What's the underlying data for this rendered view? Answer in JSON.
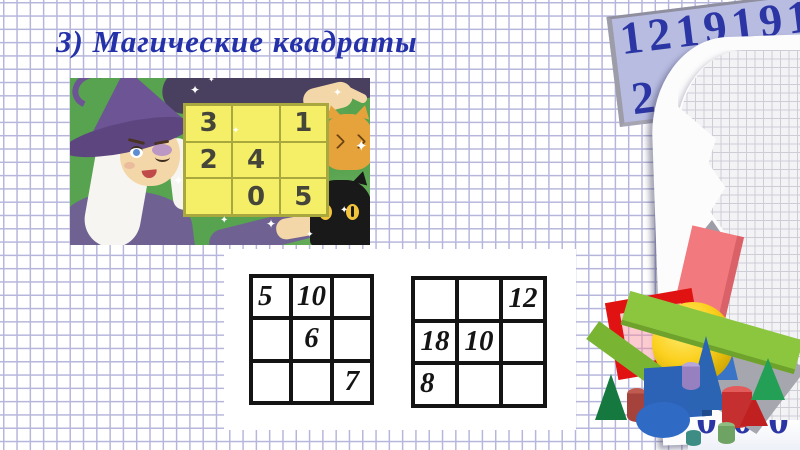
{
  "slide": {
    "title": "3) Магические квадраты"
  },
  "illustration": {
    "magic_square": {
      "rows": [
        [
          "3",
          "",
          "1"
        ],
        [
          "2",
          "4",
          ""
        ],
        [
          "",
          "0",
          "5"
        ]
      ]
    }
  },
  "puzzles": {
    "left": {
      "rows": [
        [
          "5",
          "10",
          ""
        ],
        [
          "",
          "6",
          ""
        ],
        [
          "",
          "",
          "7"
        ]
      ]
    },
    "right": {
      "rows": [
        [
          "",
          "",
          "12"
        ],
        [
          "18",
          "10",
          ""
        ],
        [
          "8",
          "",
          ""
        ]
      ]
    }
  },
  "decor": {
    "banner_row1": "1219191",
    "banner_row2": "222",
    "bottom_digits": "000",
    "sparkle_glyph": "✦"
  },
  "colors": {
    "title_blue": "#2531a8",
    "digit_blue": "#2b35a4",
    "grid_line": "#b6b6dc",
    "banner_bg": "#b8bce1",
    "witch_bg": "#58a350",
    "square_yellow": "#f5ef68",
    "puzzle_border": "#141414"
  }
}
